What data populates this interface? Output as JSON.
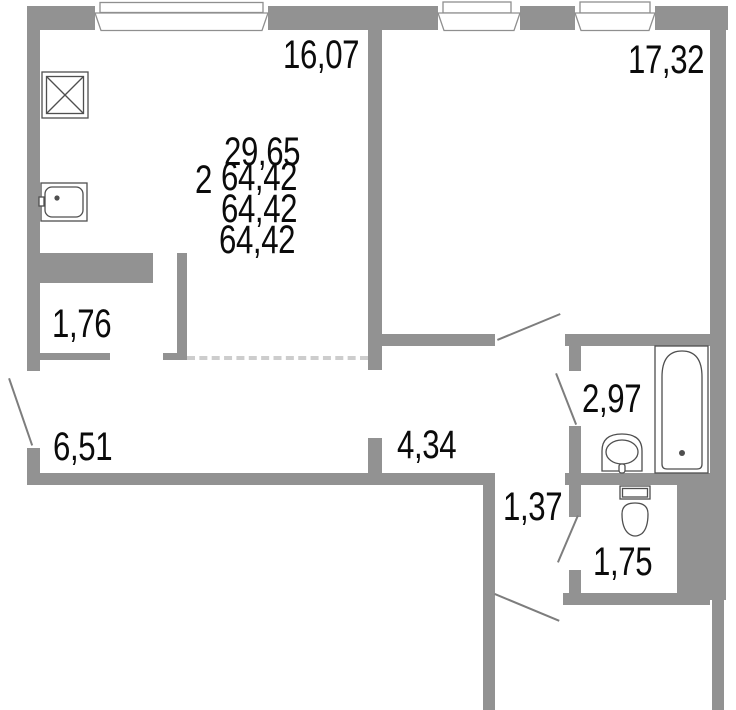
{
  "title": "2-room apartment floor plan",
  "colors": {
    "wall": "#929292",
    "dash": "#cdcdcd",
    "line": "#7d7d7d",
    "fixture": "#4f4f4f",
    "text": "#0b0b0b",
    "bg": "#ffffff"
  },
  "summary": {
    "rooms": "2",
    "living_area": "29,65",
    "total_area_1": "64,42",
    "total_area_2": "64,42",
    "total_area_3": "64,42"
  },
  "rooms": {
    "kitchen_living": "16,07",
    "bedroom": "17,32",
    "closet": "1,76",
    "hall": "6,51",
    "corridor": "4,34",
    "bathroom": "2,97",
    "passage": "1,37",
    "wc": "1,75"
  }
}
